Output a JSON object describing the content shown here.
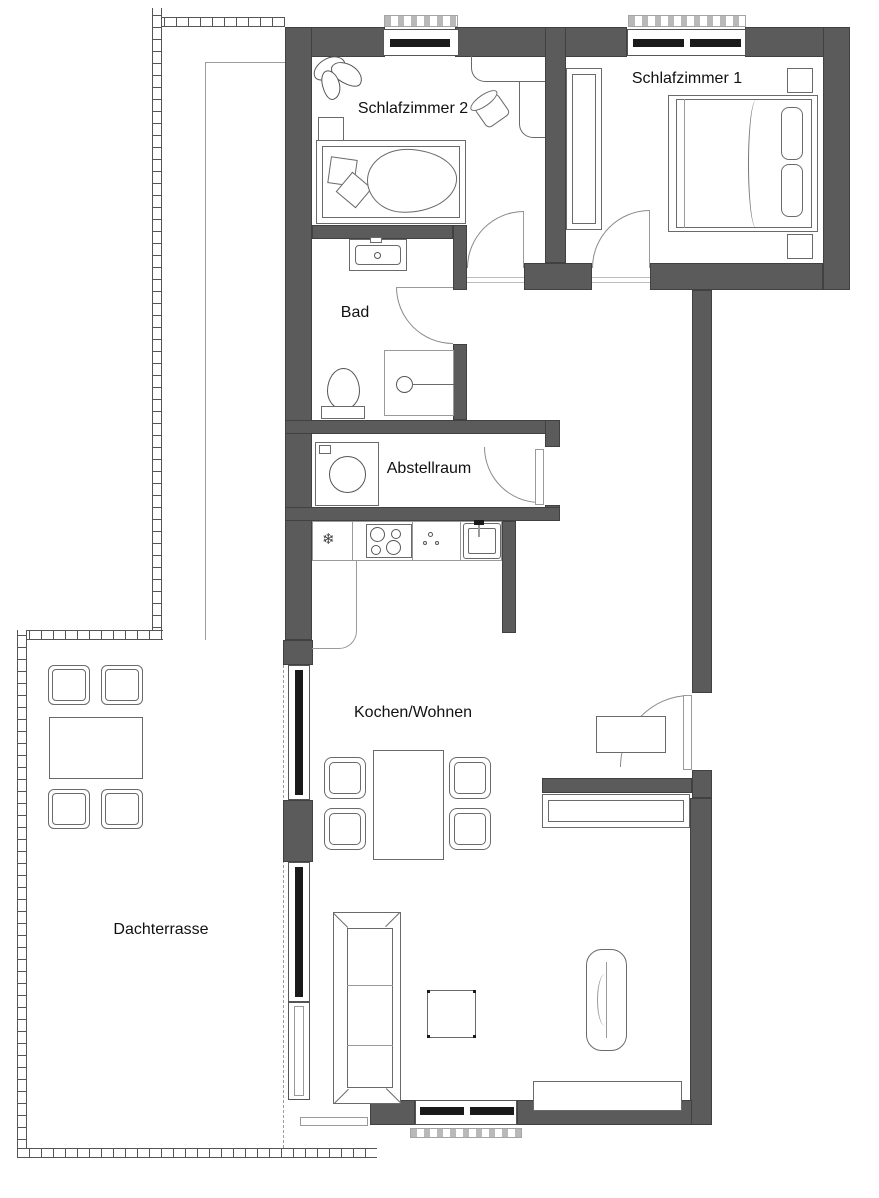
{
  "colors": {
    "wall": "#5b5b5b",
    "glazing": "#1a1a1a",
    "background": "#ffffff",
    "text": "#111111"
  },
  "rooms": {
    "schlafzimmer2": {
      "label": "Schlafzimmer 2"
    },
    "schlafzimmer1": {
      "label": "Schlafzimmer 1"
    },
    "bad": {
      "label": "Bad"
    },
    "abstellraum": {
      "label": "Abstellraum"
    },
    "kochen_wohnen": {
      "label": "Kochen/Wohnen"
    },
    "dachterrasse": {
      "label": "Dachterrasse"
    }
  },
  "kitchen": {
    "fridge_symbol": "❄"
  }
}
